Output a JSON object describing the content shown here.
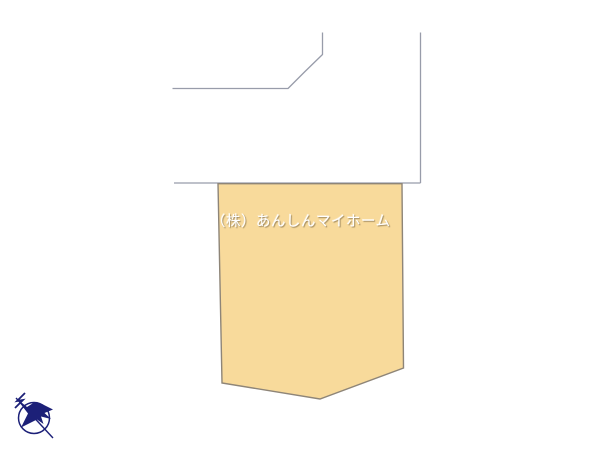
{
  "diagram": {
    "type": "real-estate-site-plan",
    "lot": {
      "watermark_text": "（株）あんしんマイホーム"
    },
    "compass": {
      "meaning": "north-direction-arrow"
    }
  },
  "colors": {
    "background": "#ffffff",
    "boundary_line": "#989caa",
    "lot_fill": "#f8da9b",
    "lot_border": "#8e8578",
    "compass_navy": "#1c2078",
    "watermark_color": "#ffffff"
  }
}
